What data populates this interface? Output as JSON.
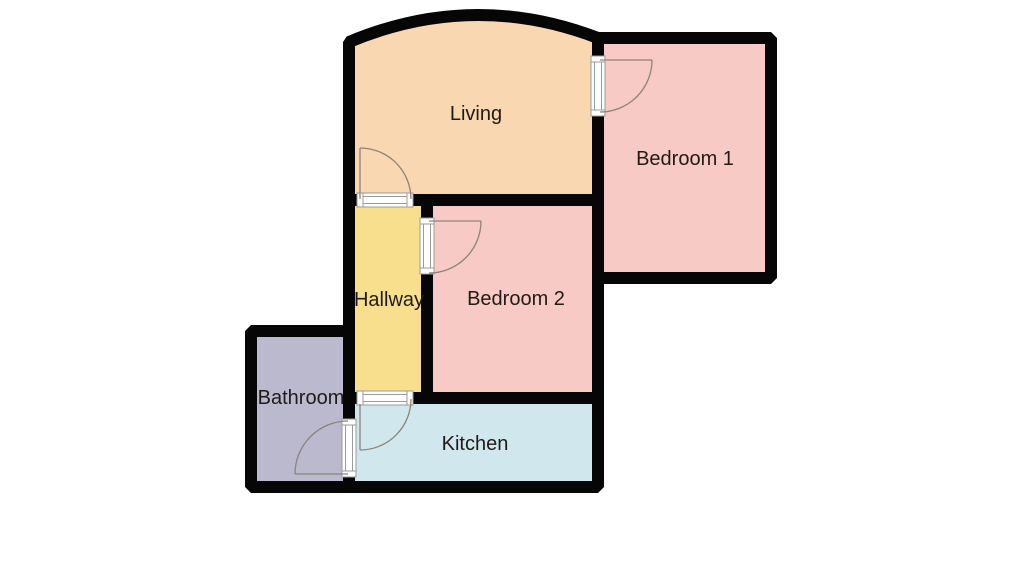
{
  "title": "Floor plan",
  "colors": {
    "background": "#ffffff",
    "wall": "#060606",
    "living": "#f9d7b0",
    "bedroom": "#f8cac5",
    "hallway": "#f8df8d",
    "bathroom": "#bab9ce",
    "kitchen": "#cfe7ed",
    "door_line": "#8d8379",
    "threshold": "#9b9b9b",
    "label": "#201b16"
  },
  "rooms": {
    "living": {
      "label": "Living"
    },
    "bedroom1": {
      "label": "Bedroom 1"
    },
    "bedroom2": {
      "label": "Bedroom 2"
    },
    "hallway": {
      "label": "Hallway"
    },
    "bathroom": {
      "label": "Bathroom"
    },
    "kitchen": {
      "label": "Kitchen"
    }
  }
}
